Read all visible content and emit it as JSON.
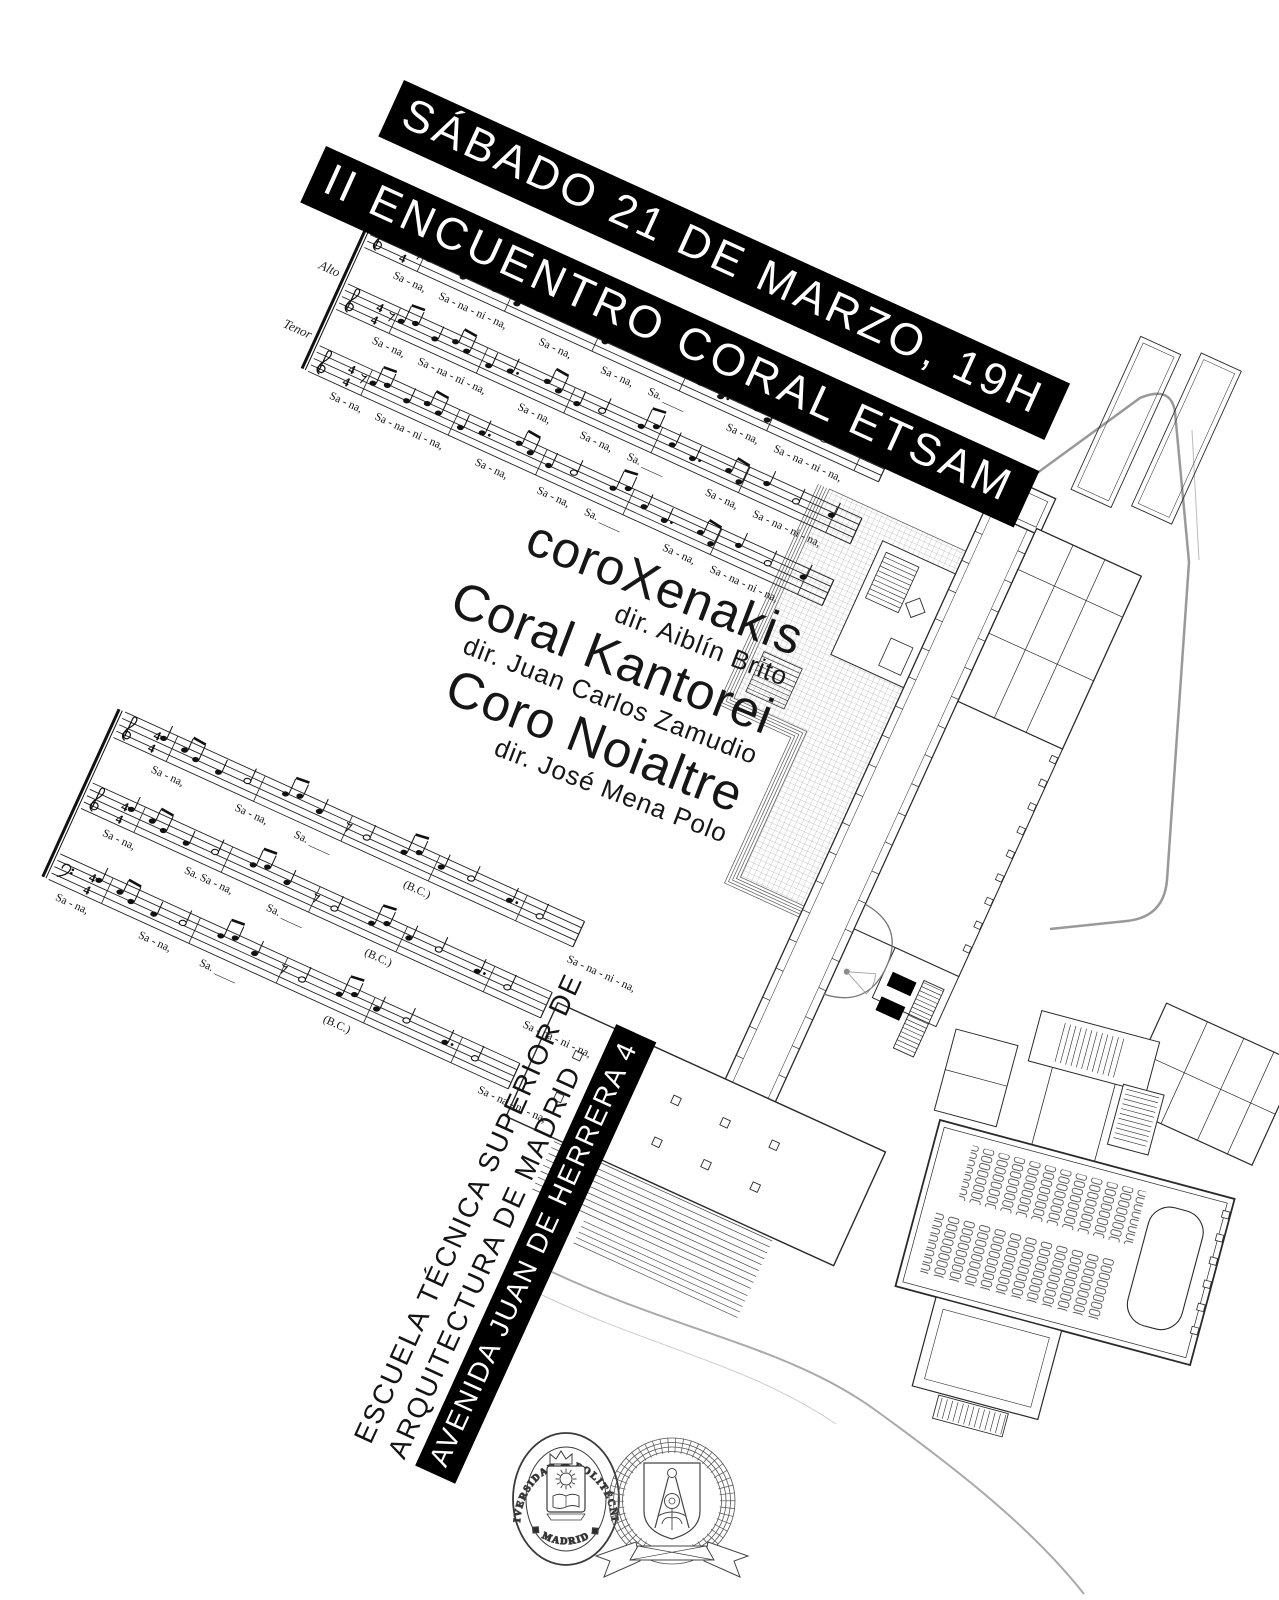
{
  "poster": {
    "banners": {
      "line1": "SÁBADO 21 DE MARZO, 19H",
      "line2": "II ENCUENTRO CORAL ETSAM"
    },
    "choirs": [
      {
        "name": "coroXenakis",
        "director": "dir. Aiblín Brito"
      },
      {
        "name": "Coral Kantorei",
        "director": "dir. Juan Carlos Zamudio"
      },
      {
        "name": "Coro Noialtre",
        "director": "dir. José Mena Polo"
      }
    ],
    "address": {
      "line1": "ESCUELA TÉCNICA SUPERIOR DE",
      "line2": "ARQUITECTURA DE MADRID",
      "line3": "AVENIDA JUAN DE HERRERA 4"
    },
    "music": {
      "time_signature_top": "4",
      "time_signature_bottom": "4",
      "system1": {
        "staves": [
          {
            "label": "Soprano",
            "lyrics": [
              "Sa - na,",
              "Sa - na - ni - na,",
              "Sa - na,",
              "Sa - na,",
              "Sa. ____",
              "Sa - na,",
              "Sa - na - ni - na,"
            ]
          },
          {
            "label": "Alto",
            "lyrics": [
              "Sa - na,",
              "Sa - na - ni - na,",
              "Sa - na,",
              "Sa - na,",
              "Sa. ____",
              "Sa - na,",
              "Sa - na - ni - na,"
            ]
          },
          {
            "label": "Tenor",
            "lyrics": [
              "Sa - na,",
              "Sa - na - ni - na,",
              "Sa - na,",
              "Sa - na,",
              "Sa. ____",
              "Sa - na,",
              "Sa - na - ni - na,"
            ]
          }
        ]
      },
      "system2": {
        "staves": [
          {
            "lyrics": [
              "Sa - na,",
              "Sa - na,",
              "Sa. ____",
              "(B.C.)",
              "Sa - na - ni - na,"
            ]
          },
          {
            "lyrics": [
              "Sa  -  na,",
              "Sa. Sa - na,",
              "Sa. ____",
              "(B.C.)",
              "Sa - na - ni - na,"
            ]
          },
          {
            "lyrics": [
              "Sa - na,",
              "Sa - na,",
              "Sa. ____",
              "(B.C.)",
              "Sa - na - ni - na,"
            ]
          }
        ]
      }
    },
    "logos": {
      "upm": {
        "arc_top": "UNIVERSIDAD ◆ POLITÉCNICA",
        "arc_bottom": "◆ MADRID ◆"
      }
    },
    "colors": {
      "banner_bg": "#000000",
      "banner_text": "#ffffff",
      "ink": "#111111",
      "plan_line": "#2a2a2a",
      "road": "#999999"
    }
  }
}
